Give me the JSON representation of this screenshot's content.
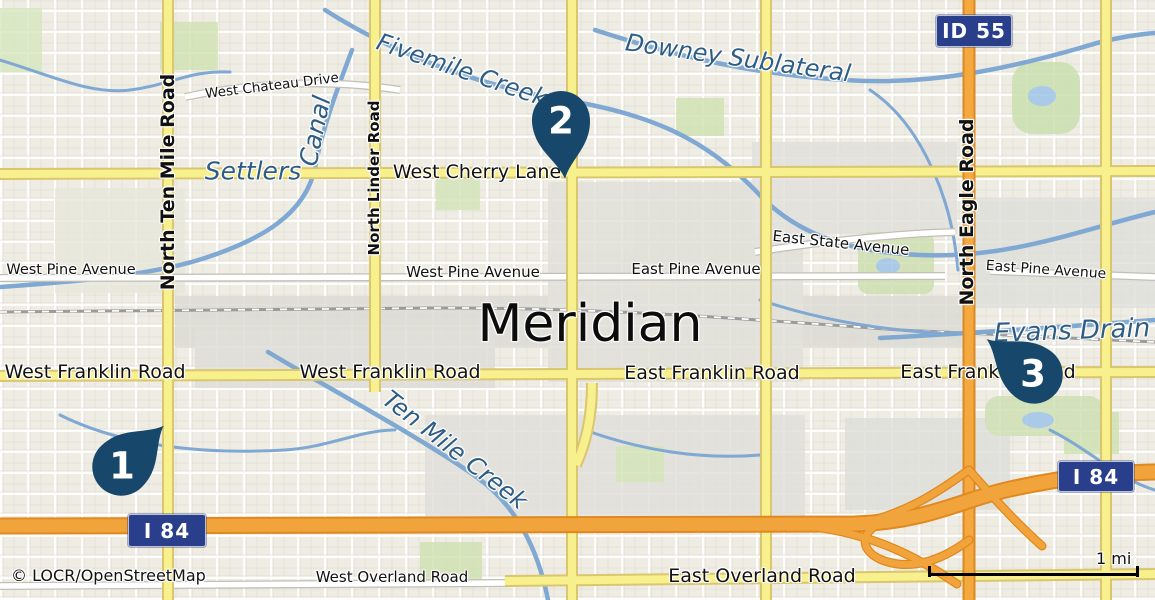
{
  "attribution": "© LOCR/OpenStreetMap",
  "scale": {
    "label": "1 mi"
  },
  "city": {
    "name": "Meridian"
  },
  "markers": [
    {
      "number": "1"
    },
    {
      "number": "2"
    },
    {
      "number": "3"
    }
  ],
  "shields": [
    {
      "label": "ID 55"
    },
    {
      "label": "I 84"
    },
    {
      "label": "I 84"
    }
  ],
  "road_labels": [
    {
      "text": "North Ten Mile Road"
    },
    {
      "text": "West Chateau Drive"
    },
    {
      "text": "North Linder Road"
    },
    {
      "text": "West Cherry Lane"
    },
    {
      "text": "West Pine Avenue"
    },
    {
      "text": "West Pine Avenue"
    },
    {
      "text": "East Pine Avenue"
    },
    {
      "text": "East State Avenue"
    },
    {
      "text": "East Pine Avenue"
    },
    {
      "text": "North Eagle Road"
    },
    {
      "text": "West Franklin Road"
    },
    {
      "text": "West Franklin Road"
    },
    {
      "text": "East Franklin Road"
    },
    {
      "text": "East Franklin Road"
    },
    {
      "text": "West Overland Road"
    },
    {
      "text": "East Overland Road"
    }
  ],
  "water_labels": [
    {
      "text": "Settlers"
    },
    {
      "text": "Canal"
    },
    {
      "text": "Fivemile Creek"
    },
    {
      "text": "Downey Sublateral"
    },
    {
      "text": "Evans Drain"
    },
    {
      "text": "Ten Mile Creek"
    }
  ],
  "colors": {
    "background": "#efece3",
    "marker": "#17476a",
    "shield": "#2a3f8c",
    "road_yellow": "#f8ef8d",
    "road_orange": "#f4a83e",
    "water": "#7fa8d2",
    "water_label": "#2d5d85"
  }
}
